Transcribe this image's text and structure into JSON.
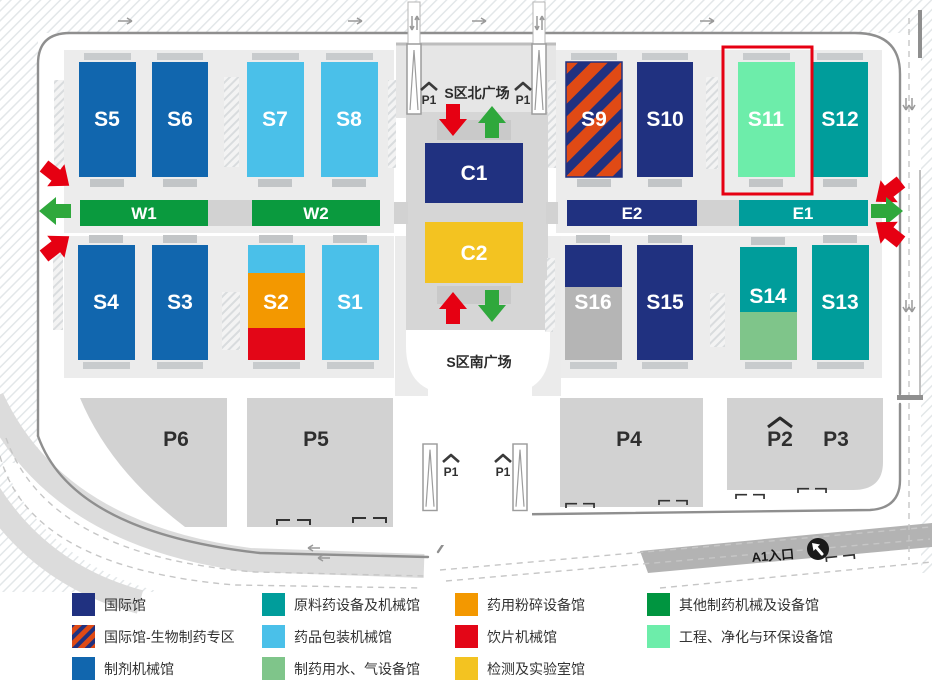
{
  "map": {
    "plaza_north": "S区北广场",
    "plaza_south": "S区南广场",
    "entrance_a1": "A1入口",
    "p1": "P1",
    "halls": {
      "s1": "S1",
      "s2": "S2",
      "s3": "S3",
      "s4": "S4",
      "s5": "S5",
      "s6": "S6",
      "s7": "S7",
      "s8": "S8",
      "s9": "S9",
      "s10": "S10",
      "s11": "S11",
      "s12": "S12",
      "s13": "S13",
      "s14": "S14",
      "s15": "S15",
      "s16": "S16",
      "c1": "C1",
      "c2": "C2",
      "w1": "W1",
      "w2": "W2",
      "e1": "E1",
      "e2": "E2"
    },
    "parking": {
      "p2": "P2",
      "p3": "P3",
      "p4": "P4",
      "p5": "P5",
      "p6": "P6"
    },
    "highlighted_hall": "S11"
  },
  "colors": {
    "navy": "#203180",
    "blue": "#1166ae",
    "light_blue": "#4ac0e9",
    "teal": "#009d9b",
    "sage": "#7fc58a",
    "orange": "#f39800",
    "red": "#e30617",
    "gold": "#f3c321",
    "green": "#0a9a3e",
    "mint": "#6dedaa",
    "stripe_red": "#e04a15",
    "gray_hall": "#b5b5b5",
    "highlight": "#e60012",
    "arrow_red": "#e60012",
    "arrow_green": "#2fa83c"
  },
  "legend": {
    "items": [
      {
        "label": "国际馆",
        "color": "#203180",
        "swatch": "solid"
      },
      {
        "label": "国际馆-生物制药专区",
        "color": "#e04a15",
        "swatch": "striped"
      },
      {
        "label": "制剂机械馆",
        "color": "#1166ae",
        "swatch": "solid"
      },
      {
        "label": "原料药设备及机械馆",
        "color": "#009d9b",
        "swatch": "solid"
      },
      {
        "label": "药品包装机械馆",
        "color": "#4ac0e9",
        "swatch": "solid"
      },
      {
        "label": "制药用水、气设备馆",
        "color": "#7fc58a",
        "swatch": "solid"
      },
      {
        "label": "药用粉碎设备馆",
        "color": "#f39800",
        "swatch": "solid"
      },
      {
        "label": "饮片机械馆",
        "color": "#e30617",
        "swatch": "solid"
      },
      {
        "label": "检测及实验室馆",
        "color": "#f3c321",
        "swatch": "solid"
      },
      {
        "label": "其他制药机械及设备馆",
        "color": "#009540",
        "swatch": "solid"
      },
      {
        "label": "工程、净化与环保设备馆",
        "color": "#6dedaa",
        "swatch": "solid"
      }
    ]
  }
}
